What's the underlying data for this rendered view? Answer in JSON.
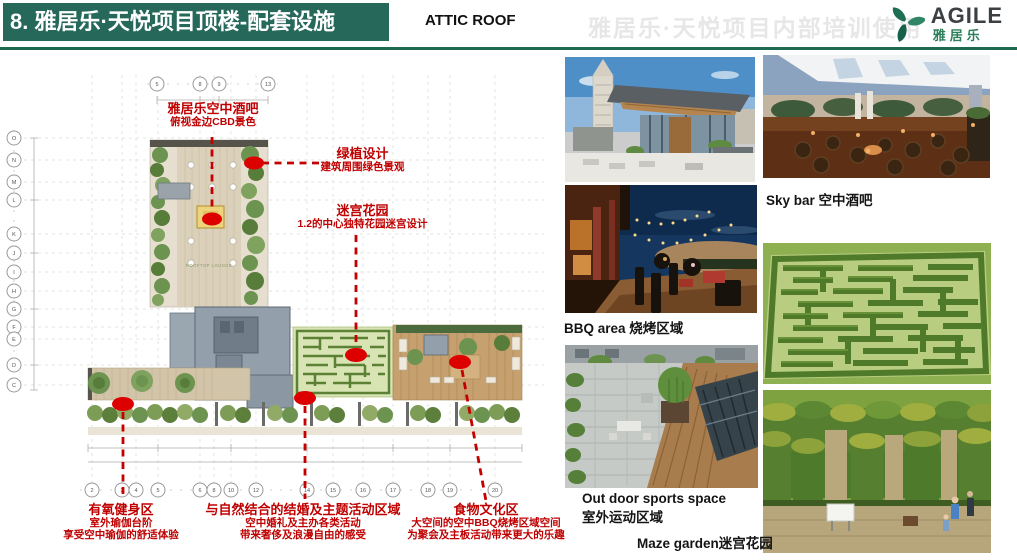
{
  "header": {
    "title": "8. 雅居乐·天悦项目顶楼-配套设施",
    "subtitle": "ATTIC ROOF",
    "watermark": "雅居乐·天悦项目内部培训使用",
    "logo_en": "AGILE",
    "logo_cn": "雅居乐",
    "colors": {
      "bar_green": "#26695B",
      "rule_green": "#1E6A50",
      "logo_green": "#2E7D5B",
      "annotation_red": "#C00000"
    }
  },
  "plan": {
    "lounge_label": "ROOFTOP LOUNGE",
    "grid_top": [
      "5",
      "8",
      "9",
      "13"
    ],
    "grid_left": [
      "O",
      "N",
      "M",
      "L",
      "K",
      "J",
      "I",
      "H",
      "G",
      "F",
      "E",
      "D",
      "C"
    ],
    "grid_bottom": [
      "2",
      "3",
      "4",
      "5",
      "6",
      "8",
      "10",
      "12",
      "14",
      "15",
      "16",
      "17",
      "18",
      "19",
      "20"
    ],
    "annotations": [
      {
        "title": "雅居乐空中酒吧",
        "lines": [
          "俯视金边CBD景色"
        ]
      },
      {
        "title": "绿植设计",
        "lines": [
          "建筑周围绿色景观"
        ]
      },
      {
        "title": "迷宫花园",
        "lines": [
          "1.2的中心独特花园迷宫设计"
        ]
      },
      {
        "title": "有氧健身区",
        "lines": [
          "室外瑜伽台阶",
          "享受空中瑜伽的舒适体验"
        ]
      },
      {
        "title": "与自然结合的结婚及主题活动区域",
        "lines": [
          "空中婚礼及主办各类活动",
          "带来奢侈及浪漫自由的感受"
        ]
      },
      {
        "title": "食物文化区",
        "lines": [
          "大空间的空中BBQ烧烤区域空间",
          "为聚会及主板活动带来更大的乐趣"
        ]
      }
    ]
  },
  "photos": {
    "skybar_caption": "Sky bar 空中酒吧",
    "bbq_caption": "BBQ area 烧烤区域",
    "outdoor_caption_en": "Out door sports space",
    "outdoor_caption_cn": "室外运动区域",
    "maze_caption": "Maze garden迷宫花园"
  }
}
